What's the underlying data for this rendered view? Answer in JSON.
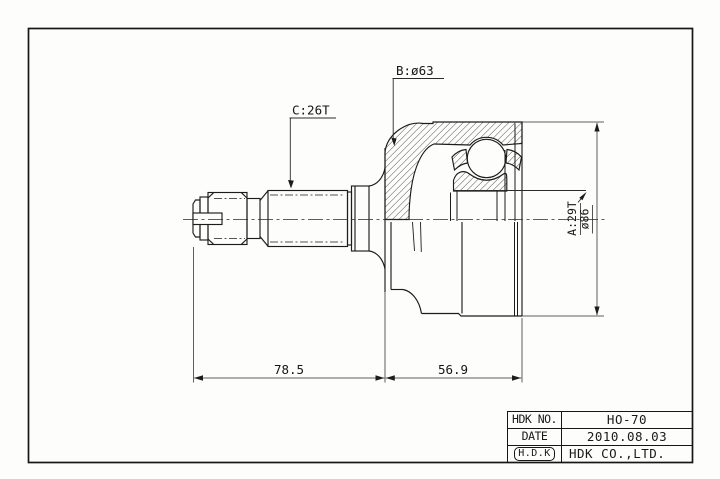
{
  "drawing": {
    "labels": {
      "c_spline": "C:26T",
      "b_dia": "B:ø63",
      "a_spline": "A:29T",
      "outer_dia": "ø86",
      "len_left": "78.5",
      "len_right": "56.9"
    }
  },
  "title_block": {
    "rows": [
      {
        "label": "HDK NO.",
        "value": "HO-70"
      },
      {
        "label": "DATE",
        "value": "2010.08.03"
      },
      {
        "label": "H.D.K",
        "value": "HDK CO.,LTD."
      }
    ]
  }
}
